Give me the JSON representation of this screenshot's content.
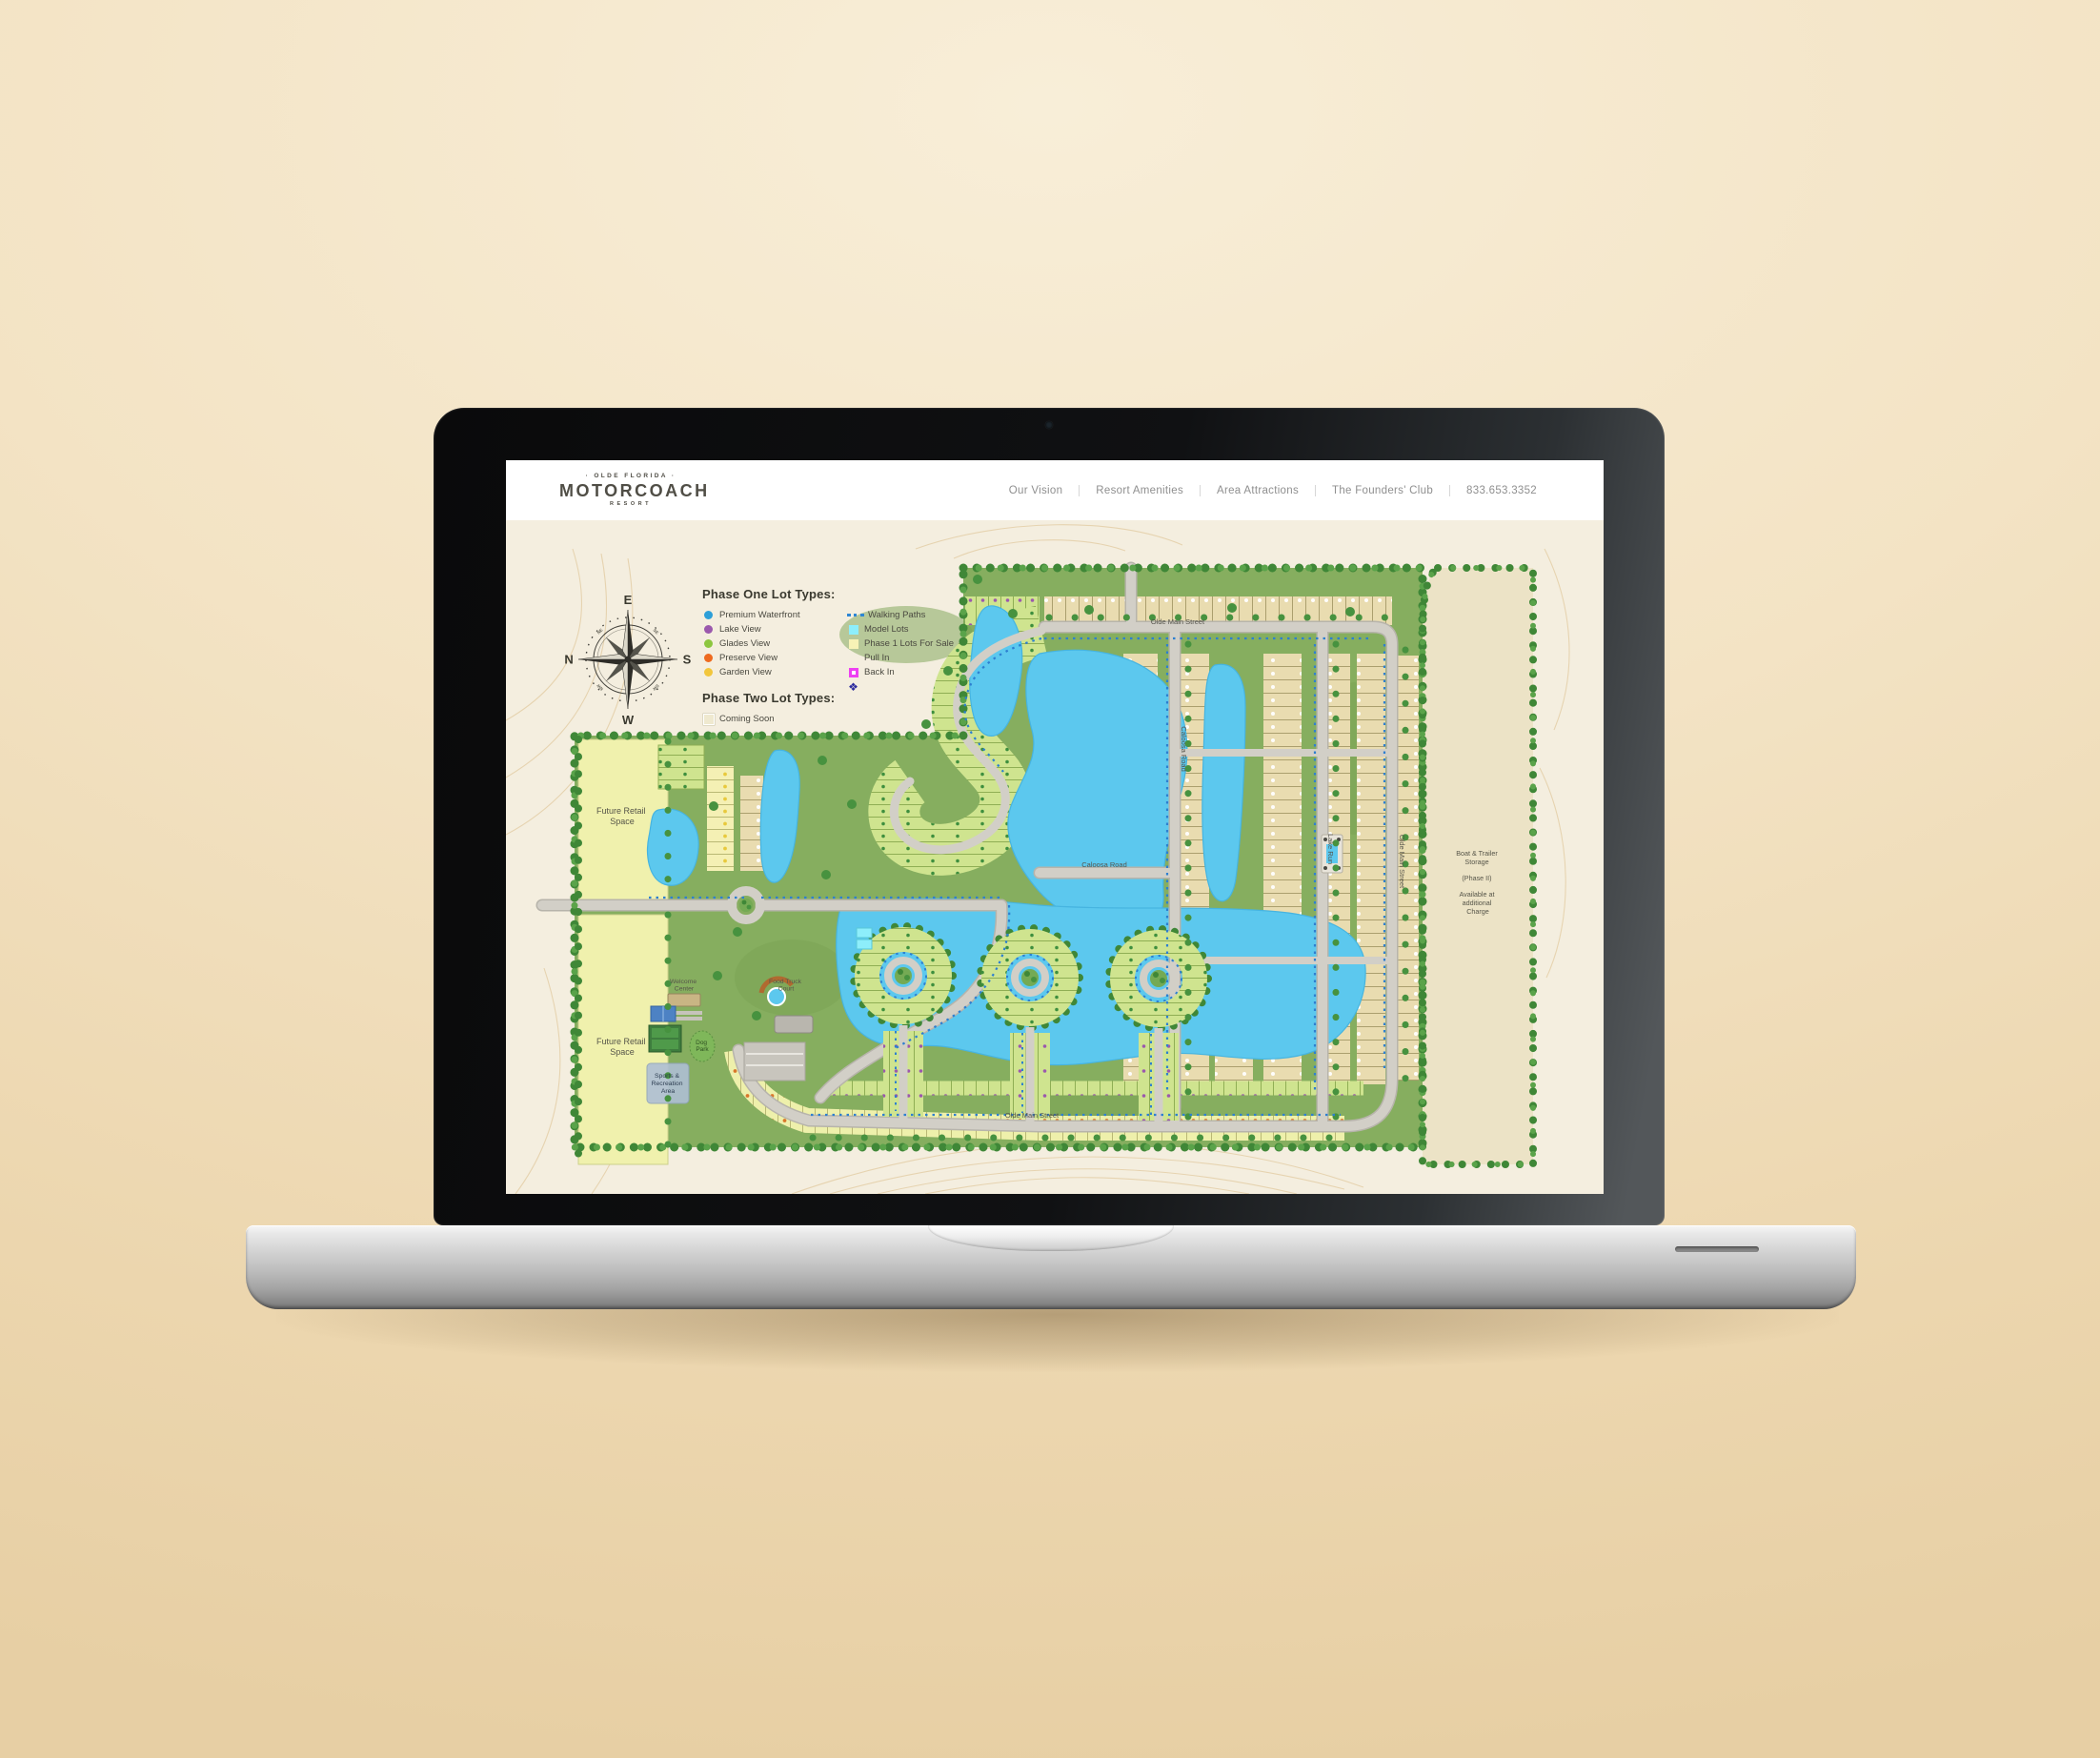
{
  "site": {
    "logo": {
      "top": "· OLDE FLORIDA ·",
      "name": "MOTORCOACH",
      "sub": "RESORT"
    },
    "nav": {
      "item1": "Our Vision",
      "item2": "Resort Amenities",
      "item3": "Area Attractions",
      "item4": "The Founders' Club",
      "phone": "833.653.3352"
    }
  },
  "legend": {
    "phase_one_title": "Phase One Lot Types:",
    "phase_two_title": "Phase Two Lot Types:",
    "col1": [
      {
        "label": "Premium Waterfront",
        "color": "#2d9fd8",
        "icon": "circle"
      },
      {
        "label": "Lake View",
        "color": "#9b59ad",
        "icon": "circle"
      },
      {
        "label": "Glades View",
        "color": "#8dc63f",
        "icon": "circle"
      },
      {
        "label": "Preserve View",
        "color": "#ee6a1f",
        "icon": "circle"
      },
      {
        "label": "Garden View",
        "color": "#f2c63c",
        "icon": "circle"
      }
    ],
    "col2": [
      {
        "label": "Walking Paths",
        "color": "#2e86d4",
        "icon": "dotted-line"
      },
      {
        "label": "Model Lots",
        "color": "#8deefb",
        "icon": "square"
      },
      {
        "label": "Phase 1 Lots For Sale",
        "color": "#f7f3b6",
        "icon": "square"
      },
      {
        "label": "Pull In",
        "color": "#ffffff",
        "icon": "none"
      },
      {
        "label": "Back In",
        "color": "#ee3ff2",
        "icon": "square-dot"
      }
    ],
    "compass_marker_color": "#2d2c9e",
    "phase_two": [
      {
        "label": "Coming Soon",
        "color": "#efe9cf",
        "icon": "square-outline"
      }
    ]
  },
  "compass": {
    "e": "E",
    "n": "N",
    "s": "S",
    "w": "W",
    "ne": "NE",
    "se": "SE",
    "nw": "NW",
    "sw": "SW"
  },
  "map": {
    "areas": {
      "future_retail": {
        "l1": "Future Retail",
        "l2": "Space"
      },
      "welcome_center": {
        "l1": "Welcome",
        "l2": "Center"
      },
      "food_truck": {
        "l1": "Food Truck",
        "l2": "Court"
      },
      "dog_park": {
        "l1": "Dog",
        "l2": "Park"
      },
      "sports_rec": {
        "l1": "Sports &",
        "l2": "Recreation",
        "l3": "Area"
      },
      "boat_storage": {
        "l1": "Boat & Trailer",
        "l2": "Storage",
        "l3": "(Phase II)",
        "l4": "Available at",
        "l5": "additional",
        "l6": "Charge"
      }
    },
    "streets": {
      "olde_main": "Olde Main Street",
      "caloosa": "Caloosa Road",
      "lake_run": "Lake Run"
    },
    "palette": {
      "water": "#5cc8ee",
      "grass": "#86ae5f",
      "trees": "#3f8737",
      "road": "#d2cfc7",
      "lot_tan": "#e9dcb0",
      "lot_green": "#cfe48f",
      "lot_yellow": "#eef0ab",
      "retail_yellow": "#f0f1ad",
      "sand": "#f4eedf",
      "storage_tan": "#ece3c6"
    }
  }
}
